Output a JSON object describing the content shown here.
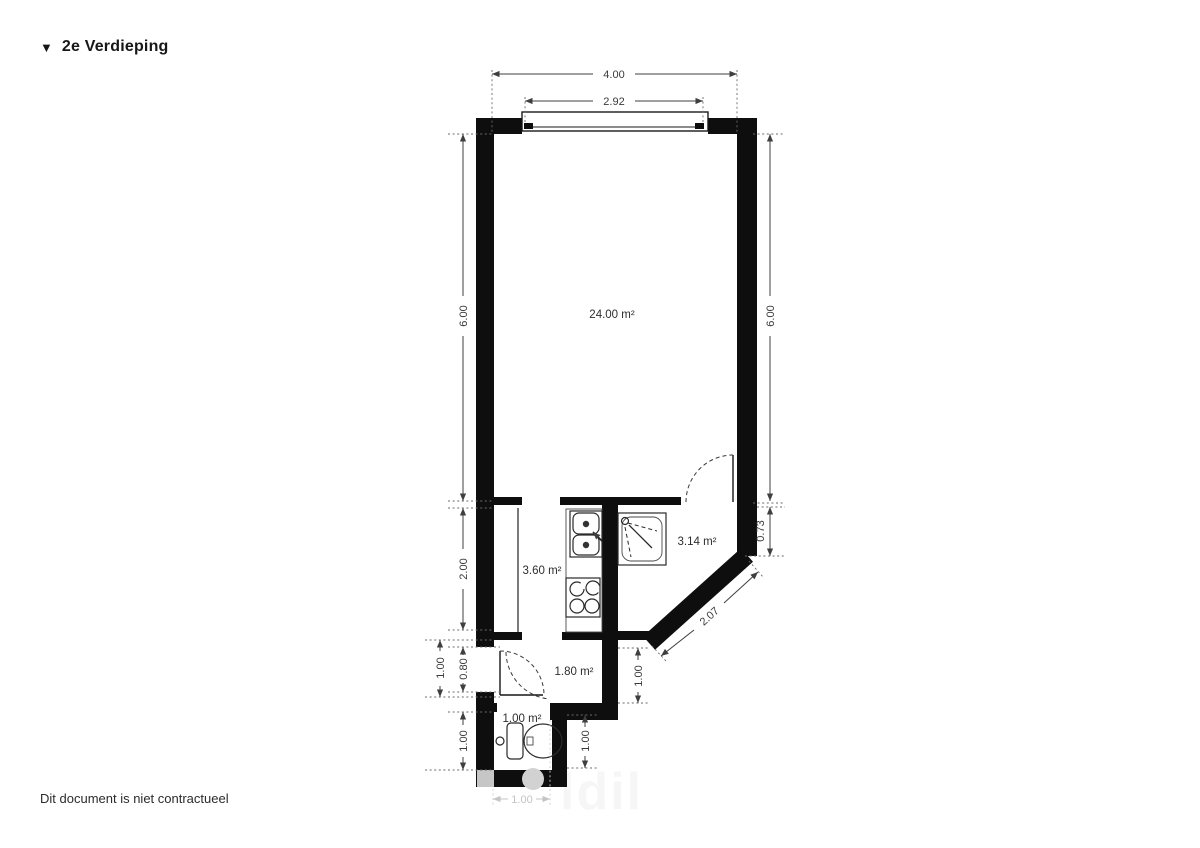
{
  "page": {
    "title_marker": "▼",
    "title": "2e Verdieping",
    "footer_note": "Dit document is niet contractueel",
    "watermark": "ldil"
  },
  "colors": {
    "wall": "#0e0e0e",
    "dimension_text": "#3a3a3a",
    "faded_dimension": "#c4c4c4",
    "fixture_gray": "#d2d2d2"
  },
  "rooms": {
    "living": "24.00 m²",
    "kitchen": "3.60 m²",
    "shower": "3.14 m²",
    "hallway": "1.80 m²",
    "toilet": "1.00 m²"
  },
  "dimensions": {
    "total_width": "4.00",
    "window_width": "2.92",
    "left_height": "6.00",
    "right_height": "6.00",
    "kitchen_left_height": "2.00",
    "right_lower": "0.73",
    "diagonal_wall": "2.07",
    "entry_outer": "1.00",
    "entry_door": "0.80",
    "toilet_left_height": "1.00",
    "hall_right": "1.00",
    "toilet_right_height": "1.00",
    "toilet_bottom_width": "1.00"
  }
}
